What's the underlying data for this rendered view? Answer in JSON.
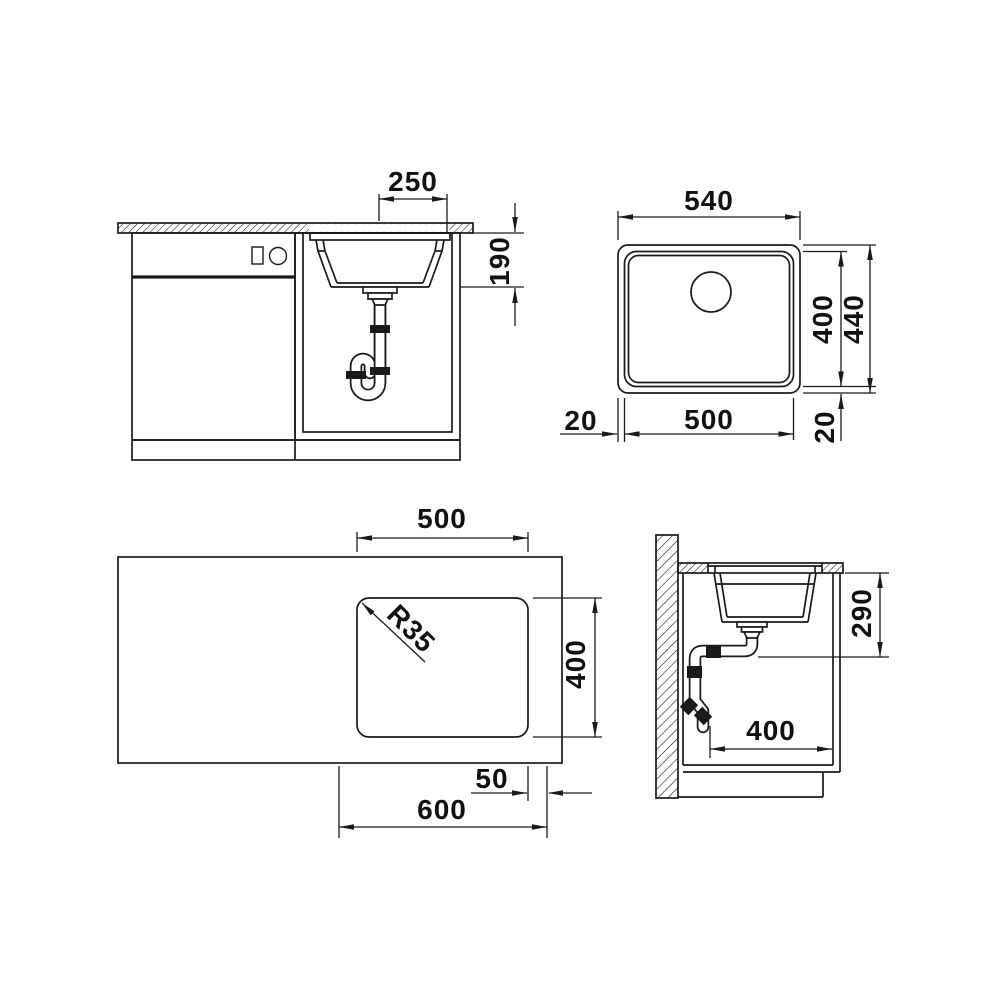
{
  "sheet": {
    "background": "#ffffff",
    "line_color": "#1a1a1a",
    "text_color": "#111111"
  },
  "views": {
    "front": {
      "dims": {
        "drain_offset": "250",
        "bowl_depth": "190"
      }
    },
    "top": {
      "dims": {
        "outer_width": "540",
        "inner_length": "400",
        "outer_length": "440",
        "rim_left": "20",
        "inner_width": "500",
        "rim_bottom": "20"
      }
    },
    "plan": {
      "dims": {
        "cutout_width": "500",
        "corner_radius": "R35",
        "cutout_length": "400",
        "edge_offset": "50",
        "cabinet_width": "600"
      }
    },
    "side": {
      "dims": {
        "installation_depth": "290",
        "cabinet_depth": "400"
      }
    }
  }
}
